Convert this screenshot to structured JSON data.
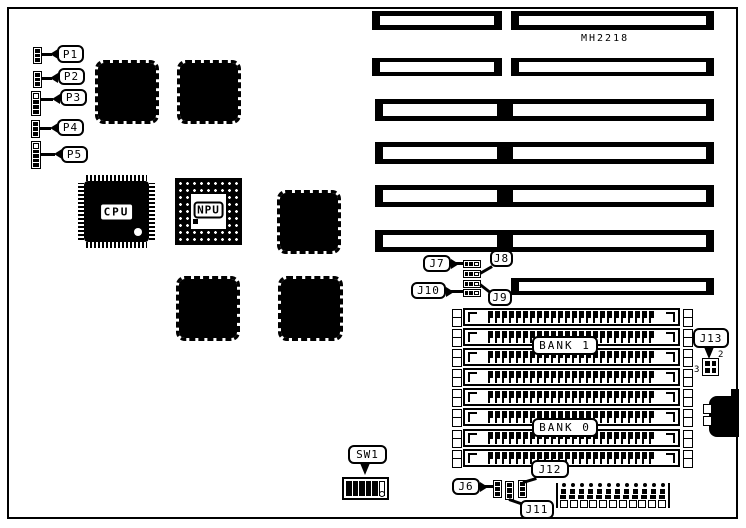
{
  "diagram": {
    "part_number": "MH2218",
    "chips": {
      "cpu": "CPU",
      "npu": "NPU"
    },
    "memory_banks": {
      "bank0": "BANK 0",
      "bank1": "BANK 1",
      "simm_rows": 8
    },
    "connector_labels": {
      "p1": "P1",
      "p2": "P2",
      "p3": "P3",
      "p4": "P4",
      "p5": "P5",
      "j6": "J6",
      "j7": "J7",
      "j8": "J8",
      "j9": "J9",
      "j10": "J10",
      "j11": "J11",
      "j12": "J12",
      "j13": "J13",
      "j13_pin2": "2",
      "j13_pin3": "3",
      "sw1": "SW1"
    },
    "power_connector": {
      "top_pins": 12,
      "bottom_pins": 11
    },
    "colors": {
      "ink": "#000000",
      "background": "#ffffff"
    }
  }
}
